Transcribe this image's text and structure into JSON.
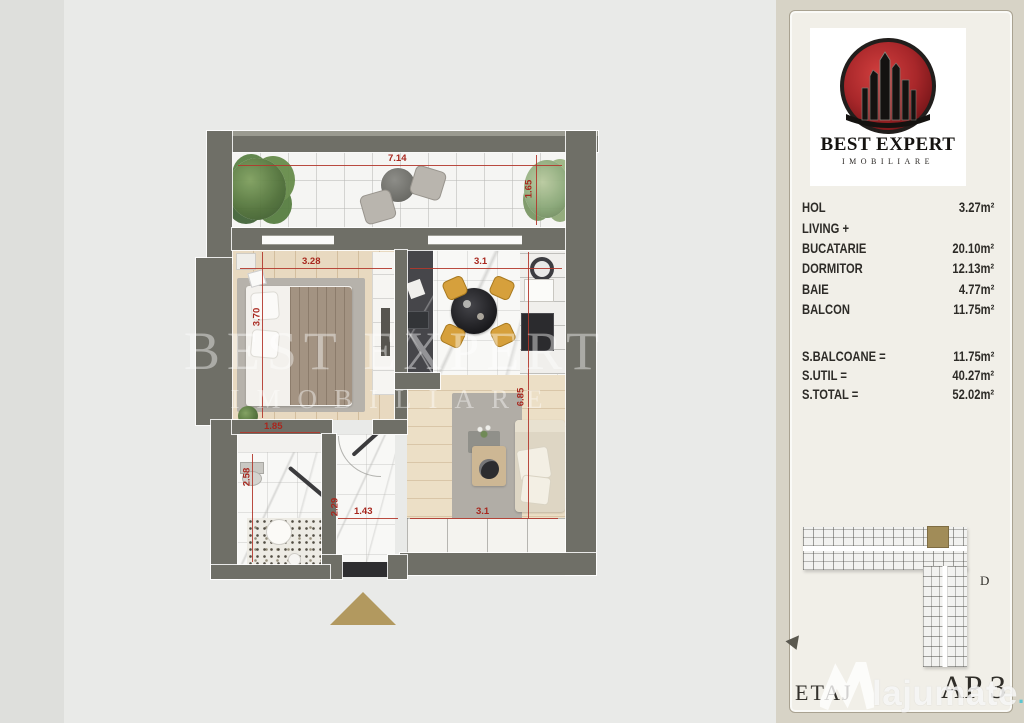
{
  "plan": {
    "watermark": {
      "line1": "BEST EXPERT",
      "line2": "IMOBILIARE"
    },
    "dims": {
      "balcony_w": "7.14",
      "balcony_d": "1.65",
      "bedroom_w": "3.28",
      "bedroom_d": "3.70",
      "kitchen_w": "3.1",
      "living_w": "3.1",
      "living_d": "6.85",
      "bath_w": "1.85",
      "bath_d": "2.58",
      "hall_w": "1.43",
      "hall_d": "2.29"
    }
  },
  "panel": {
    "logo": {
      "title": "BEST EXPERT",
      "subtitle": "IMOBILIARE"
    },
    "rooms": [
      {
        "label": "HOL",
        "value": "3.27m²"
      },
      {
        "label": "LIVING +",
        "value": ""
      },
      {
        "label": "BUCATARIE",
        "value": "20.10m²"
      },
      {
        "label": "DORMITOR",
        "value": "12.13m²"
      },
      {
        "label": "BAIE",
        "value": "4.77m²"
      },
      {
        "label": "BALCON",
        "value": "11.75m²"
      }
    ],
    "totals": [
      {
        "label": "S.BALCOANE =",
        "value": "11.75m²"
      },
      {
        "label": "S.UTIL =",
        "value": "40.27m²"
      },
      {
        "label": "S.TOTAL =",
        "value": "52.02m²"
      }
    ],
    "keyplan": {
      "section_label": "D"
    },
    "floor_label": "ETAJ",
    "apartment_label": "AP 3"
  },
  "site_watermark": {
    "name": "lajumate",
    "tld": ".ro"
  },
  "colors": {
    "accent_red": "#b3372c",
    "wall": "#6f6f67",
    "highlight_unit": "#a18c58",
    "logo_red": "#b22a2c"
  }
}
